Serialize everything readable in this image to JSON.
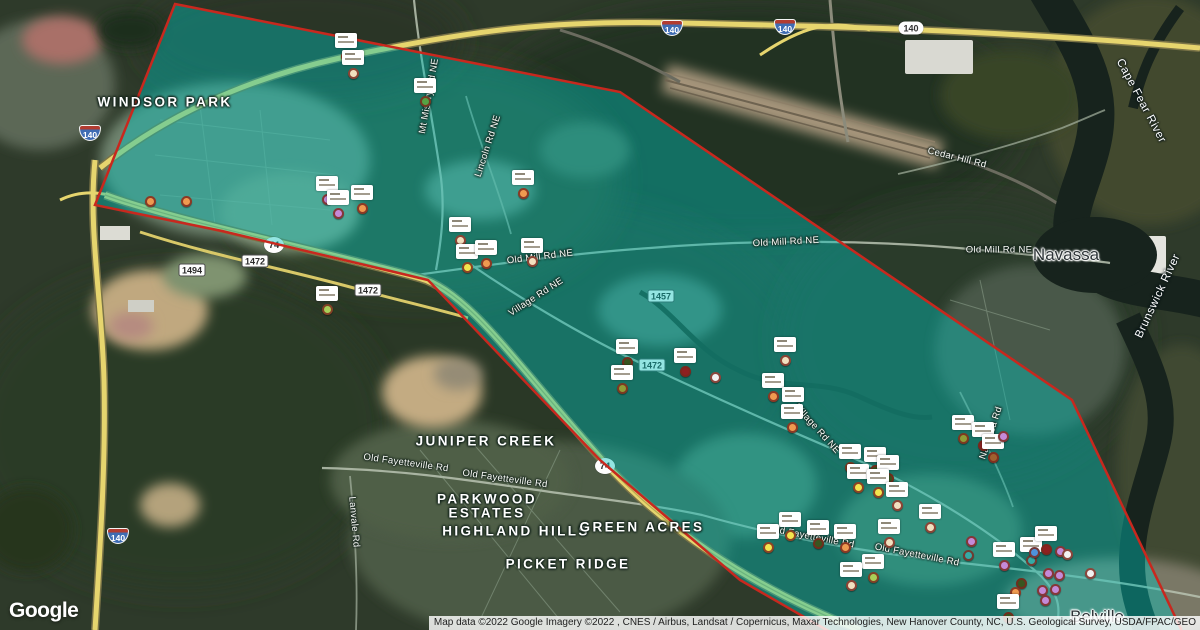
{
  "logo": {
    "text": "Google"
  },
  "attribution": {
    "text": "Map data ©2022 Google Imagery ©2022 , CNES / Airbus, Landsat / Copernicus, Maxar Technologies, New Hanover County, NC, U.S. Geological Survey, USDA/FPAC/GEO"
  },
  "overlay": {
    "fill": "#00c4bc",
    "fill_opacity": 0.42,
    "border_color": "#c8281e",
    "polygon": "175,4 620,92 1072,400 1190,648 858,648 740,580 600,460 428,280 222,231 95,205"
  },
  "place_labels": [
    {
      "text": "WINDSOR PARK",
      "x": 165,
      "y": 102,
      "type": "hood"
    },
    {
      "text": "JUNIPER CREEK",
      "x": 486,
      "y": 441,
      "type": "hood"
    },
    {
      "text": "PARKWOOD",
      "x": 487,
      "y": 499,
      "type": "hood"
    },
    {
      "text": "ESTATES",
      "x": 487,
      "y": 513,
      "type": "hood"
    },
    {
      "text": "HIGHLAND HILLS",
      "x": 516,
      "y": 531,
      "type": "hood"
    },
    {
      "text": "GREEN ACRES",
      "x": 642,
      "y": 527,
      "type": "hood"
    },
    {
      "text": "PICKET RIDGE",
      "x": 568,
      "y": 564,
      "type": "hood"
    },
    {
      "text": "Navassa",
      "x": 1066,
      "y": 255,
      "type": "town"
    },
    {
      "text": "Belville",
      "x": 1097,
      "y": 617,
      "type": "town"
    }
  ],
  "road_labels": [
    {
      "text": "Mt Misery Rd NE",
      "x": 429,
      "y": 96,
      "rot": -80,
      "type": "road"
    },
    {
      "text": "Lincoln Rd NE",
      "x": 488,
      "y": 146,
      "rot": -72,
      "type": "road"
    },
    {
      "text": "Old Mill Rd NE",
      "x": 540,
      "y": 257,
      "rot": -7,
      "type": "road"
    },
    {
      "text": "Village Rd NE",
      "x": 536,
      "y": 297,
      "rot": -33,
      "type": "road"
    },
    {
      "text": "Old Mill Rd NE",
      "x": 786,
      "y": 242,
      "rot": -3,
      "type": "road"
    },
    {
      "text": "Old Mill Rd NE",
      "x": 999,
      "y": 250,
      "rot": 0,
      "type": "road"
    },
    {
      "text": "Cedar Hill Rd",
      "x": 957,
      "y": 158,
      "rot": 14,
      "type": "road"
    },
    {
      "text": "Old Fayetteville Rd",
      "x": 406,
      "y": 463,
      "rot": 8,
      "type": "road"
    },
    {
      "text": "Old Fayetteville Rd",
      "x": 505,
      "y": 479,
      "rot": 8,
      "type": "road"
    },
    {
      "text": "Old Fayetteville Rd",
      "x": 812,
      "y": 537,
      "rot": 11,
      "type": "road"
    },
    {
      "text": "Old Fayetteville Rd",
      "x": 917,
      "y": 555,
      "rot": 11,
      "type": "road"
    },
    {
      "text": "Lanvale Rd",
      "x": 354,
      "y": 522,
      "rot": 85,
      "type": "road"
    },
    {
      "text": "Village Rd NE",
      "x": 817,
      "y": 429,
      "rot": 48,
      "type": "road"
    },
    {
      "text": "Navassa Rd",
      "x": 991,
      "y": 433,
      "rot": -72,
      "type": "road"
    },
    {
      "text": "Cape Fear River",
      "x": 1141,
      "y": 101,
      "rot": 62,
      "type": "water"
    },
    {
      "text": "Brunswick River",
      "x": 1158,
      "y": 296,
      "rot": -65,
      "type": "water"
    }
  ],
  "shields": [
    {
      "type": "interstate",
      "text": "140",
      "x": 90,
      "y": 133
    },
    {
      "type": "interstate",
      "text": "140",
      "x": 672,
      "y": 28
    },
    {
      "type": "interstate",
      "text": "140",
      "x": 785,
      "y": 27
    },
    {
      "type": "interstate",
      "text": "140",
      "x": 118,
      "y": 536
    },
    {
      "type": "pill",
      "text": "140",
      "x": 911,
      "y": 28
    },
    {
      "type": "circle",
      "text": "74",
      "x": 274,
      "y": 245
    },
    {
      "type": "circle",
      "text": "74",
      "x": 605,
      "y": 466
    },
    {
      "type": "rect",
      "text": "1472",
      "x": 255,
      "y": 261
    },
    {
      "type": "rect",
      "text": "1494",
      "x": 192,
      "y": 270
    },
    {
      "type": "rect",
      "text": "1472",
      "x": 368,
      "y": 290
    },
    {
      "type": "rect",
      "text": "1457",
      "x": 661,
      "y": 296
    },
    {
      "type": "rect",
      "text": "1472",
      "x": 652,
      "y": 365
    }
  ],
  "markers": [
    {
      "x": 150,
      "y": 201,
      "c": "#ef9a50",
      "b": 0
    },
    {
      "x": 186,
      "y": 201,
      "c": "#ef9a50",
      "b": 0
    },
    {
      "x": 346,
      "y": 56,
      "c": "#ef9a50",
      "b": 1
    },
    {
      "x": 353,
      "y": 73,
      "c": "#f2e0bf",
      "b": 1
    },
    {
      "x": 327,
      "y": 199,
      "c": "#c48ad8",
      "b": 1
    },
    {
      "x": 338,
      "y": 213,
      "c": "#c48ad8",
      "b": 1
    },
    {
      "x": 362,
      "y": 208,
      "c": "#ef9a50",
      "b": 1
    },
    {
      "x": 425,
      "y": 101,
      "c": "#55a344",
      "b": 1
    },
    {
      "x": 523,
      "y": 193,
      "c": "#ef9a50",
      "b": 1
    },
    {
      "x": 460,
      "y": 240,
      "c": "#f2e0bf",
      "b": 1
    },
    {
      "x": 467,
      "y": 267,
      "c": "#f3e54e",
      "b": 1
    },
    {
      "x": 486,
      "y": 263,
      "c": "#ef9a50",
      "b": 1
    },
    {
      "x": 532,
      "y": 261,
      "c": "#f2e0bf",
      "b": 1
    },
    {
      "x": 327,
      "y": 309,
      "c": "#a9cf58",
      "b": 1
    },
    {
      "x": 627,
      "y": 362,
      "c": "#39551f",
      "b": 1
    },
    {
      "x": 622,
      "y": 388,
      "c": "#8f9c36",
      "b": 1
    },
    {
      "x": 685,
      "y": 371,
      "c": "#8e2020",
      "b": 1
    },
    {
      "x": 715,
      "y": 377,
      "c": "#f2f2f2",
      "b": 0
    },
    {
      "x": 785,
      "y": 360,
      "c": "#f2e0bf",
      "b": 1
    },
    {
      "x": 773,
      "y": 396,
      "c": "#ef9a50",
      "b": 1
    },
    {
      "x": 793,
      "y": 410,
      "c": "#8e2020",
      "b": 1
    },
    {
      "x": 792,
      "y": 427,
      "c": "#ef9a50",
      "b": 1
    },
    {
      "x": 850,
      "y": 467,
      "c": "#8f9c36",
      "b": 1
    },
    {
      "x": 875,
      "y": 470,
      "c": "#39551f",
      "b": 1
    },
    {
      "x": 888,
      "y": 478,
      "c": "#39551f",
      "b": 1
    },
    {
      "x": 858,
      "y": 487,
      "c": "#f3e54e",
      "b": 1
    },
    {
      "x": 878,
      "y": 492,
      "c": "#f3e54e",
      "b": 1
    },
    {
      "x": 897,
      "y": 505,
      "c": "#f2e0bf",
      "b": 1
    },
    {
      "x": 933,
      "y": 511,
      "c": "#f2e0bf",
      "b": 0
    },
    {
      "x": 963,
      "y": 438,
      "c": "#8f9c36",
      "b": 1
    },
    {
      "x": 983,
      "y": 445,
      "c": "#8e2020",
      "b": 1
    },
    {
      "x": 993,
      "y": 457,
      "c": "#9f612f",
      "b": 1
    },
    {
      "x": 1003,
      "y": 436,
      "c": "#c48ad8",
      "b": 0
    },
    {
      "x": 790,
      "y": 535,
      "c": "#f3e54e",
      "b": 1
    },
    {
      "x": 768,
      "y": 547,
      "c": "#f3e54e",
      "b": 1
    },
    {
      "x": 818,
      "y": 543,
      "c": "#39551f",
      "b": 1
    },
    {
      "x": 845,
      "y": 547,
      "c": "#ef9a50",
      "b": 1
    },
    {
      "x": 889,
      "y": 542,
      "c": "#f2e0bf",
      "b": 1
    },
    {
      "x": 873,
      "y": 577,
      "c": "#a9cf58",
      "b": 1
    },
    {
      "x": 851,
      "y": 585,
      "c": "#f2e0bf",
      "b": 1
    },
    {
      "x": 930,
      "y": 527,
      "c": "#f2e0bf",
      "b": 1
    },
    {
      "x": 971,
      "y": 541,
      "c": "#c48ad8",
      "b": 0
    },
    {
      "x": 968,
      "y": 555,
      "c": "#35aaa5",
      "b": 0
    },
    {
      "x": 1004,
      "y": 565,
      "c": "#c48ad8",
      "b": 1
    },
    {
      "x": 1031,
      "y": 560,
      "c": "#35aaa5",
      "b": 1
    },
    {
      "x": 1046,
      "y": 549,
      "c": "#8e2020",
      "b": 1
    },
    {
      "x": 1034,
      "y": 552,
      "c": "#4e92dc",
      "b": 0
    },
    {
      "x": 1060,
      "y": 551,
      "c": "#c48ad8",
      "b": 0
    },
    {
      "x": 1067,
      "y": 554,
      "c": "#f2f2f2",
      "b": 0
    },
    {
      "x": 1048,
      "y": 573,
      "c": "#c48ad8",
      "b": 0
    },
    {
      "x": 1059,
      "y": 575,
      "c": "#c48ad8",
      "b": 0
    },
    {
      "x": 1090,
      "y": 573,
      "c": "#f2f2f2",
      "b": 0
    },
    {
      "x": 1021,
      "y": 583,
      "c": "#39551f",
      "b": 0
    },
    {
      "x": 1015,
      "y": 592,
      "c": "#ef9a50",
      "b": 0
    },
    {
      "x": 1042,
      "y": 590,
      "c": "#c48ad8",
      "b": 0
    },
    {
      "x": 1055,
      "y": 589,
      "c": "#c48ad8",
      "b": 0
    },
    {
      "x": 1045,
      "y": 600,
      "c": "#c48ad8",
      "b": 0
    },
    {
      "x": 1008,
      "y": 617,
      "c": "#39551f",
      "b": 1
    }
  ]
}
